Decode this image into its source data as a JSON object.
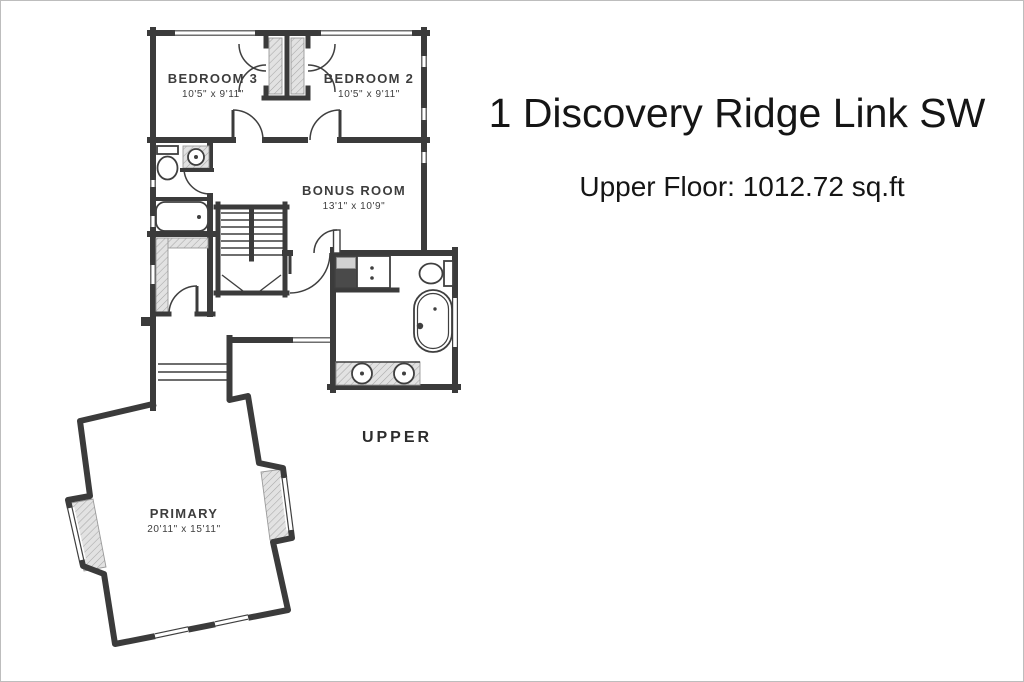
{
  "header": {
    "title": "1 Discovery Ridge Link SW",
    "subtitle": "Upper Floor: 1012.72 sq.ft"
  },
  "plan": {
    "floor_label": "UPPER",
    "rooms": {
      "bedroom3": {
        "name": "BEDROOM 3",
        "dims": "10'5\" x 9'11\""
      },
      "bedroom2": {
        "name": "BEDROOM 2",
        "dims": "10'5\" x 9'11\""
      },
      "bonus_room": {
        "name": "BONUS ROOM",
        "dims": "13'1\" x 10'9\""
      },
      "primary": {
        "name": "PRIMARY",
        "dims": "20'11\" x 15'11\""
      }
    }
  },
  "colors": {
    "wall": "#3b3b3b",
    "fixture_line": "#3f3f3f",
    "hatch_fill": "#e2e2e2",
    "hatch_line": "#a8a8a8",
    "label_text": "#3d3d3d",
    "title_text": "#151515",
    "background": "#ffffff",
    "frame_border": "#bdbdbd",
    "shower_fill": "#4a4a4a",
    "shelf_fill": "#d2d2d2"
  }
}
